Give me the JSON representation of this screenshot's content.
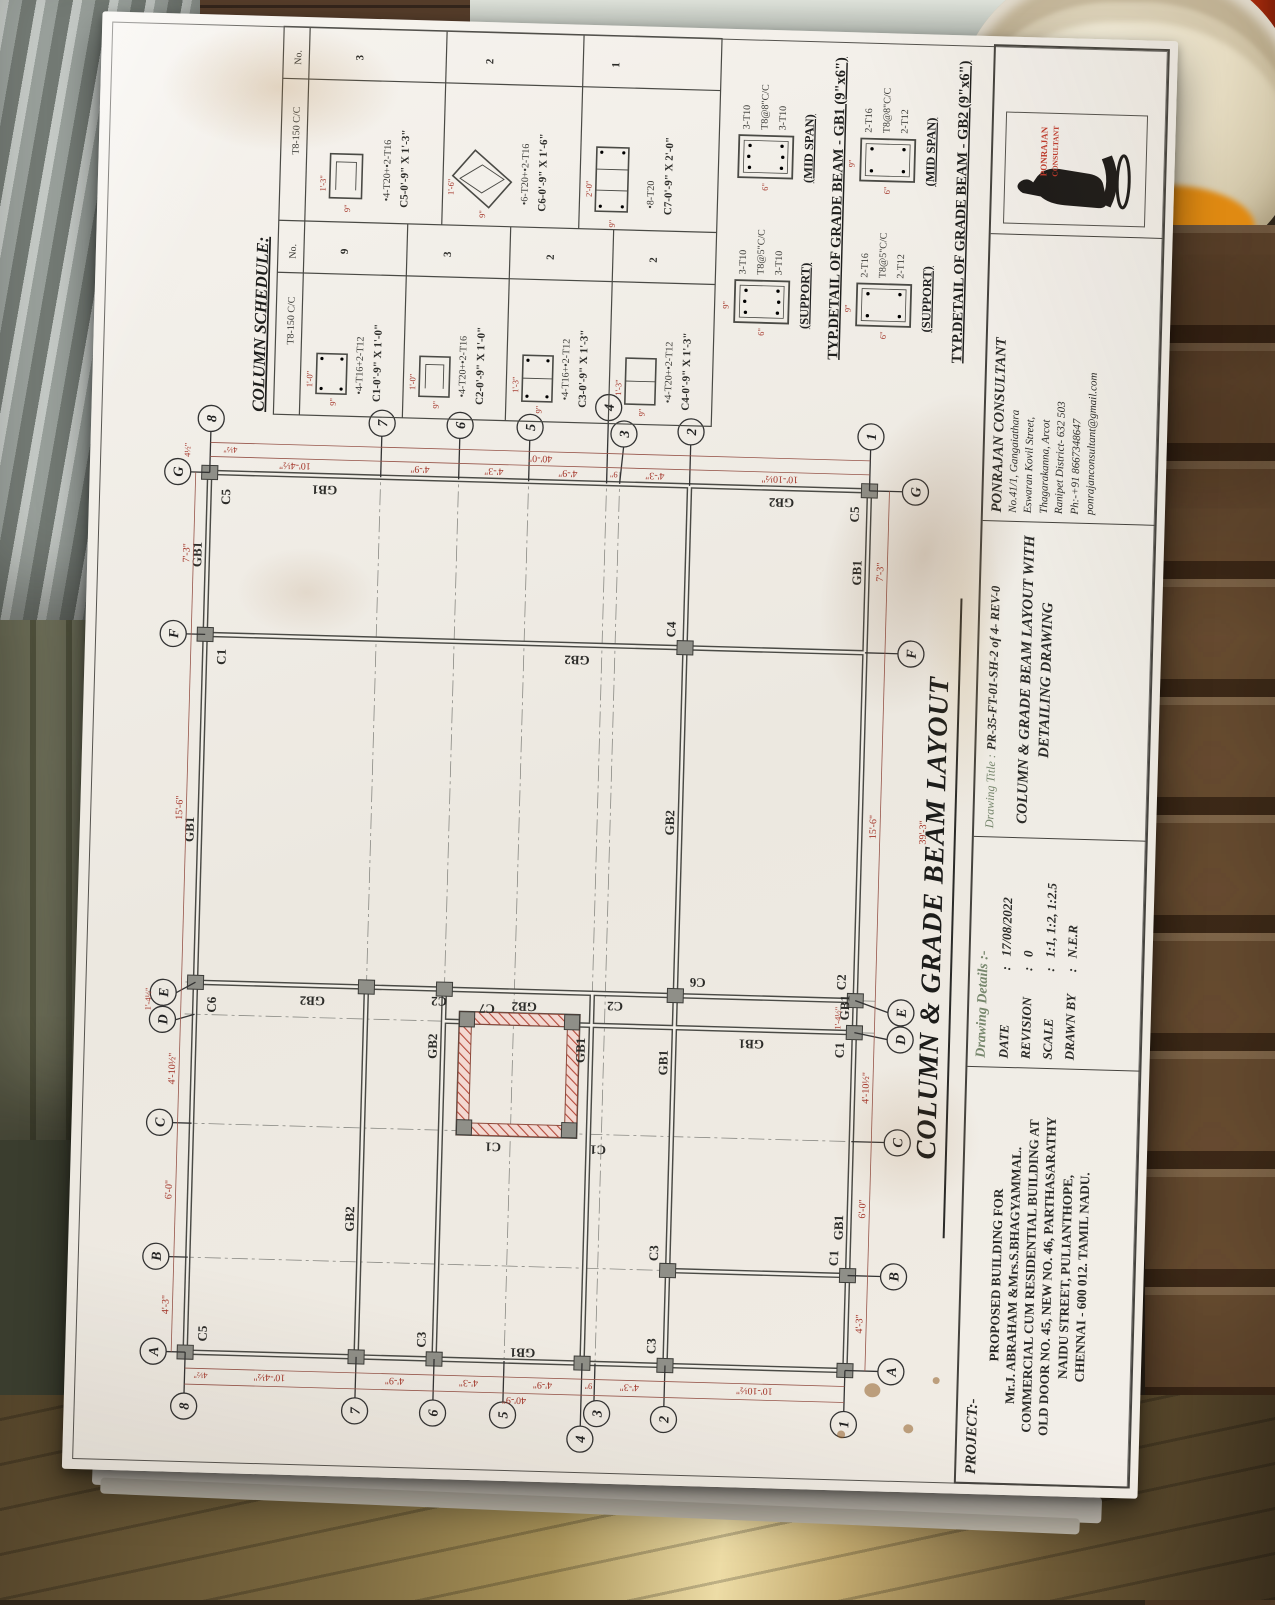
{
  "schedule": {
    "title": "COLUMN SCHEDULE:",
    "header_stirrup": "T8-150 C/C",
    "header_no": "No.",
    "rows": [
      {
        "size_w": "1'-0\"",
        "size_d": "9\"",
        "bars": "•4-T16+2-T12",
        "label": "C1-0'-9\" X 1'-0\"",
        "qty": "9"
      },
      {
        "size_w": "1'-0\"",
        "size_d": "9\"",
        "bars": "•4-T20+•2-T16",
        "label": "C2-0'-9\" X 1'-0\"",
        "qty": "3"
      },
      {
        "size_w": "1'-3\"",
        "size_d": "9\"",
        "bars": "•4-T16+•2-T12",
        "label": "C3-0'-9\" X 1'-3\"",
        "qty": "2"
      },
      {
        "size_w": "1'-3\"",
        "size_d": "9\"",
        "bars": "•4-T20+•2-T12",
        "label": "C4-0'-9\" X 1'-3\"",
        "qty": "2"
      },
      {
        "size_w": "1'-3\"",
        "size_d": "9\"",
        "bars": "•4-T20+•2-T16",
        "label": "C5-0'-9\" X 1'-3\"",
        "qty": "3"
      },
      {
        "size_w": "1'-6\"",
        "size_d": "9\"",
        "bars": "•6-T20+•2-T16",
        "label": "C6-0'-9\" X 1'-6\"",
        "qty": "2"
      },
      {
        "size_w": "2'-0\"",
        "size_d": "9\"",
        "bars": "•8-T20",
        "label": "C7-0'-9\" X 2'-0\"",
        "qty": "1"
      }
    ]
  },
  "gb_details": [
    {
      "title": "TYP.DETAIL OF GRADE BEAM - GB1 (9\"x6\")",
      "support": {
        "top": "3-T10",
        "stirrup": "T8@5\"C/C",
        "bottom": "3-T10",
        "caption": "(SUPPORT)"
      },
      "midspan": {
        "top": "3-T10",
        "stirrup": "T8@8\"C/C",
        "bottom": "3-T10",
        "caption": "(MID SPAN)"
      },
      "dim_w": "9\"",
      "dim_d": "6\""
    },
    {
      "title": "TYP.DETAIL OF GRADE BEAM - GB2 (9\"x6\")",
      "support": {
        "top": "2-T16",
        "stirrup": "T8@5\"C/C",
        "bottom": "2-T12",
        "caption": "(SUPPORT)"
      },
      "midspan": {
        "top": "2-T16",
        "stirrup": "T8@8\"C/C",
        "bottom": "2-T12",
        "caption": "(MID SPAN)"
      },
      "dim_w": "9\"",
      "dim_d": "6\""
    }
  ],
  "plan": {
    "letters": [
      "A",
      "B",
      "C",
      "D",
      "E",
      "F",
      "G"
    ],
    "numbers": [
      "8",
      "7",
      "6",
      "5",
      "4",
      "3",
      "2",
      "1"
    ],
    "letter_dims": [
      "4'-3\"",
      "6'-0\"",
      "4'-10½\"",
      "1'-4½\"",
      "15'-6\"",
      "7'-3\""
    ],
    "letter_overall": "39'-3\"",
    "number_dims": [
      "10'-4½\"",
      "4'-9\"",
      "4'-3\"",
      "4'-9\"",
      "9\"",
      "4'-3\"",
      "10'-10½\""
    ],
    "overall_right": "40'-0\"",
    "overall_left": "40'-9\"",
    "offset": "4½\"",
    "gb1": "GB1",
    "gb2": "GB2",
    "c1": "C1",
    "c2": "C2",
    "c3": "C3",
    "c4": "C4",
    "c5": "C5",
    "c6": "C6",
    "c7": "C7"
  },
  "main_title": "COLUMN & GRADE BEAM  LAYOUT",
  "title_block": {
    "project": {
      "label": "PROJECT:-",
      "lines": [
        "PROPOSED BUILDING FOR",
        "Mr.J. ABRAHAM &Mrs.S.BHAGYAMMAL.",
        "COMMERCIAL CUM RESIDENTIAL BUILDING AT",
        "OLD DOOR NO. 45, NEW NO. 46, PARTHASARATHY",
        "NAIDU STREET, PULIANTHOPE,",
        "CHENNAI - 600 012. TAMIL NADU."
      ]
    },
    "details": {
      "heading": "Drawing Details :-",
      "rows": [
        {
          "k": "DATE",
          "c": ":",
          "v": "17/08/2022"
        },
        {
          "k": "REVISION",
          "c": ":",
          "v": "0"
        },
        {
          "k": "SCALE",
          "c": ":",
          "v": "1:1, 1:2, 1:2.5"
        },
        {
          "k": "DRAWN BY",
          "c": ":",
          "v": "N.E.R"
        }
      ]
    },
    "drawing_title": {
      "label": "Drawing Title :",
      "number": "PR-35-FT-01-SH-2 of 4- REV-0",
      "name1": "COLUMN & GRADE BEAM LAYOUT WITH",
      "name2": "DETAILING DRAWING"
    },
    "consultant": {
      "name": "PONRAJAN CONSULTANT",
      "lines": [
        "No.41/1, Gangaiathara",
        "Eswaran Kovil Street,",
        "Thagarakanna, Arcot",
        "Ranipet District- 632 503",
        "Ph:-+91 8667348647",
        "ponrajanconsultant@gmail.com"
      ]
    },
    "logo": {
      "line1": "PONRAJAN",
      "line2": "CONSULTANT"
    }
  }
}
